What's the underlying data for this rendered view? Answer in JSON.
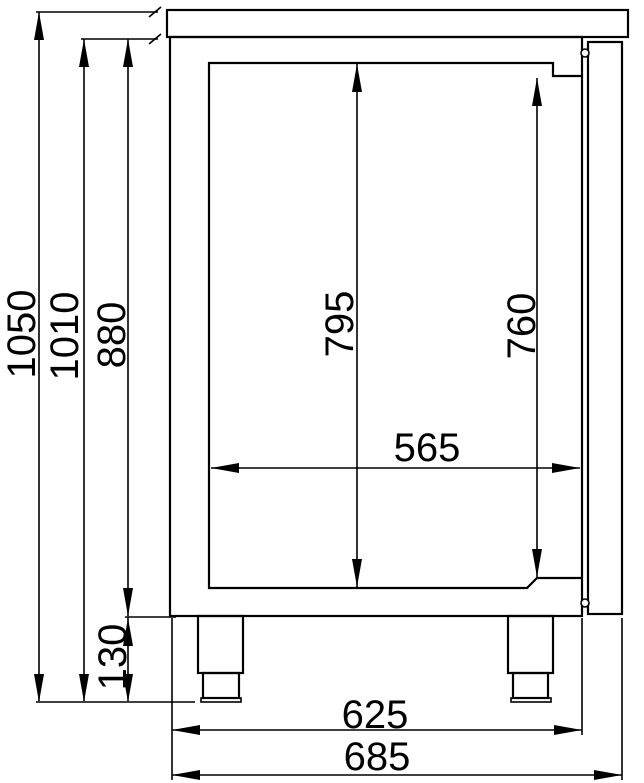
{
  "drawing": {
    "type": "technical-dimension-drawing",
    "view": "side-section of refrigerated counter cabinet",
    "background_color": "#ffffff",
    "line_color": "#000000",
    "labels": {
      "overall_height": "1050",
      "height_under_worktop": "1010",
      "body_height": "880",
      "interior_height": "795",
      "door_opening_height": "760",
      "interior_depth": "565",
      "leg_height": "130",
      "body_depth": "625",
      "overall_depth": "685"
    }
  }
}
